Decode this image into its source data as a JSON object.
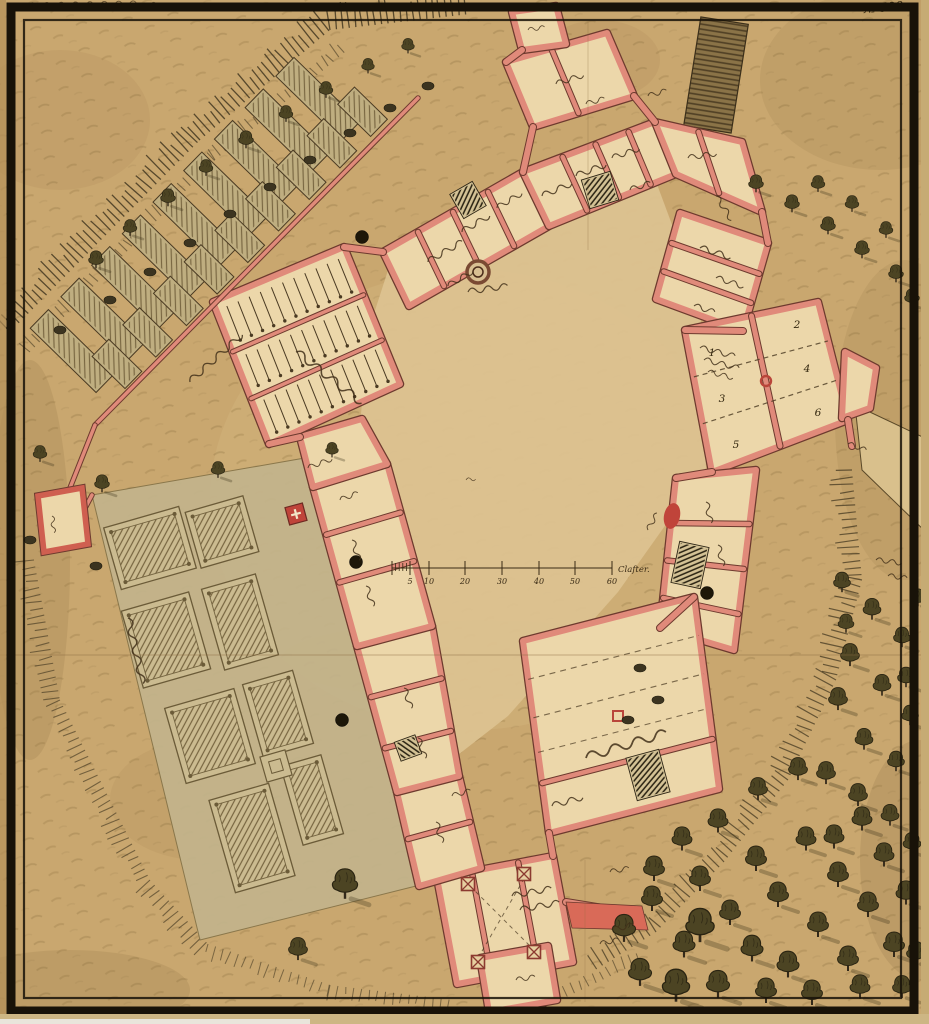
{
  "document": {
    "type": "hand-drawn fortification ground plan, manuscript scan",
    "plan_number": "№ 598.",
    "top_left_inscription": "illegible cursive archival inscription",
    "handwriting_note": "room labels in old German Kurrent cursive, illegible at scan resolution"
  },
  "scale_bar": {
    "ticks": [
      "5",
      "10",
      "20",
      "30",
      "40",
      "50",
      "60"
    ],
    "unit": "Clafter."
  },
  "east_wing": {
    "room_numbers": [
      "1",
      "2",
      "3",
      "4",
      "5",
      "6"
    ]
  },
  "features": {
    "courtyard_well": "circular well in inner courtyard",
    "scale_bar": "graphic scale in Klafter drawn across the courtyard",
    "formal_garden": "parterre garden with hatched beds on the south-west side",
    "kitchen_beds": "rows of hatched garden beds along the north-west rampart",
    "stables": "stalls with tether posts in the north-west range",
    "bridge": "hatched causeway leaving the north-east gate through the frame",
    "forest": "broadleaf woodland on the eastern and southern slopes"
  },
  "colors": {
    "paper": "#c9a76f",
    "wall_pink": "#e08a7a",
    "wall_red": "#c0443a",
    "room_cream": "#ecd7aa",
    "courtyard": "#dcc290",
    "ink": "#3c2f1b",
    "foliage": "#47411f",
    "frame_black": "#191309",
    "garden_panel": "#c3b48c"
  }
}
